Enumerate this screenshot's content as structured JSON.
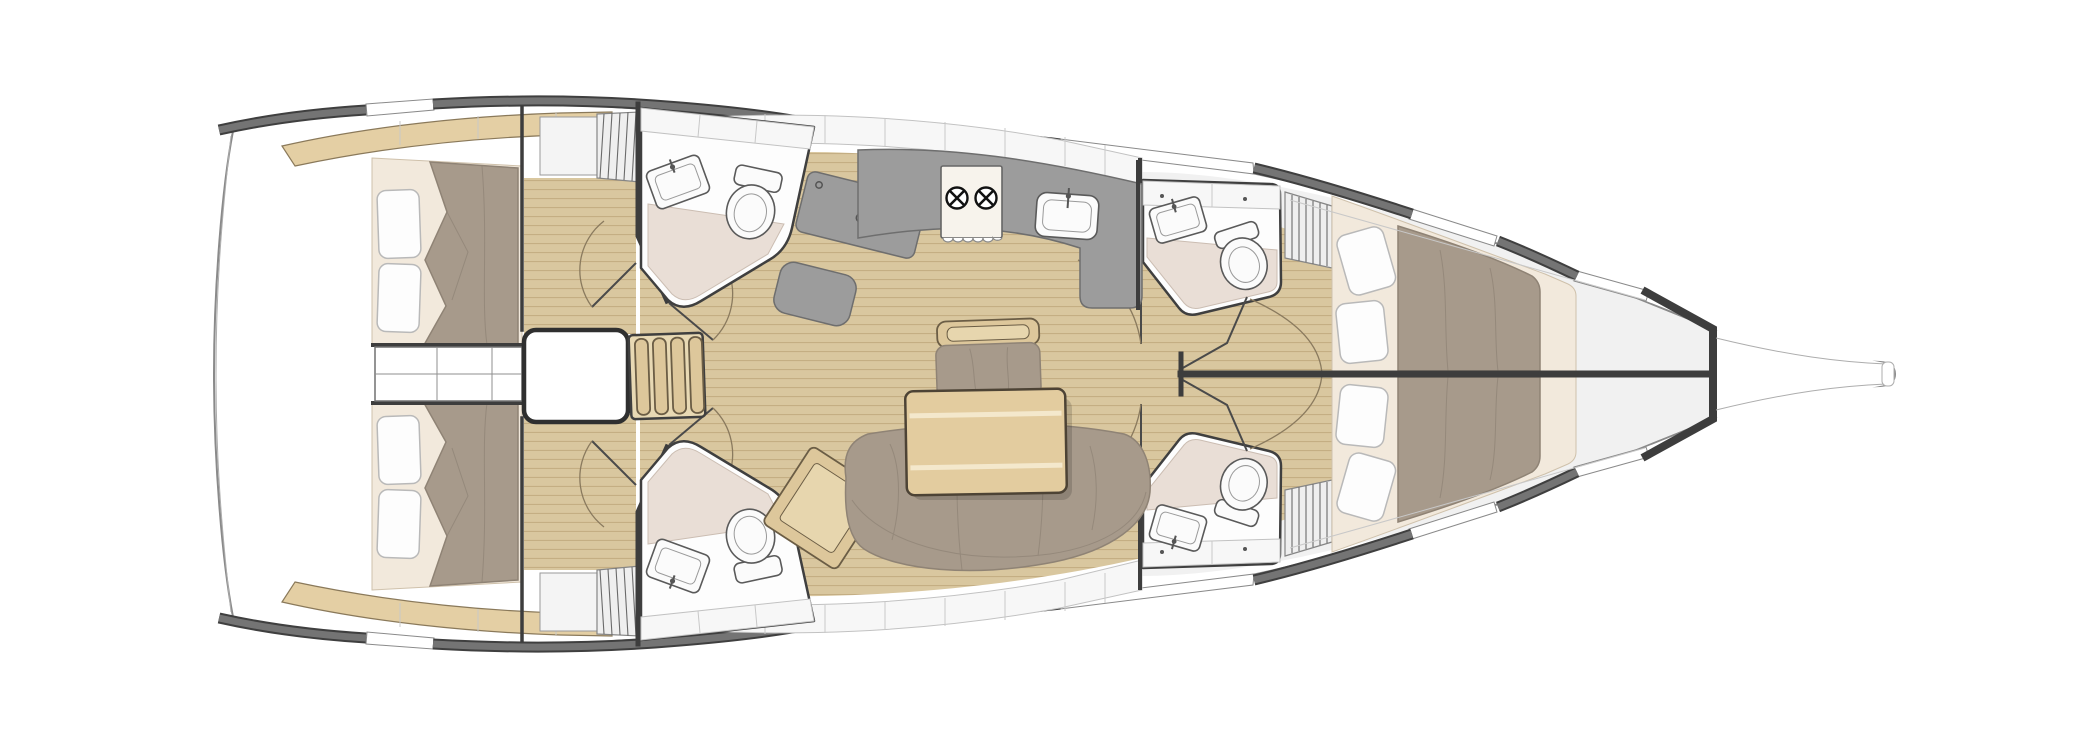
{
  "diagram": {
    "type": "yacht-interior-deck-plan",
    "title": "Sailing yacht interior layout plan — 4 cabins, 4 heads, top view, bow to the right",
    "orientation": {
      "bow": "right",
      "stern": "left",
      "port": "top",
      "starboard": "bottom"
    },
    "palette": {
      "hull_outline": "#8a8a8a",
      "bulkhead": "#3d3d3d",
      "rail": "#747474",
      "rail_edge": "#3f3f3f",
      "floor_wood": "#d9c79f",
      "floor_wood_line": "#ab8f62",
      "furniture_wood": "#ddc79b",
      "furniture_wood_dark": "#6b5d45",
      "upholstery": "#a79a8b",
      "upholstery_dark": "#8f8375",
      "mattress": "#f2e9dc",
      "pillow": "#fdfdfd",
      "counter": "#9c9c9c",
      "shower_floor": "#e9ded6",
      "deck": "#f1f1f1",
      "locker_white": "#f7f7f7"
    },
    "rooms": [
      {
        "id": "aft-cabin-port",
        "label": "Aft cabin port side — double berth with duvet, 2 pillows, wardrobe with louvred door, shelf",
        "pillows": 2
      },
      {
        "id": "aft-cabin-starboard",
        "label": "Aft cabin starboard side — double berth with duvet, 2 pillows, wardrobe with louvred door, shelf",
        "pillows": 2
      },
      {
        "id": "aft-head-port",
        "label": "Aft head port side — washbasin, toilet, shower floor",
        "fixtures": [
          "sink",
          "toilet",
          "shower"
        ]
      },
      {
        "id": "mid-head-starboard",
        "label": "Midship head starboard side — washbasin, toilet, shower floor",
        "fixtures": [
          "sink",
          "toilet",
          "shower"
        ]
      },
      {
        "id": "galley",
        "label": "Galley — L-shaped counter with 2-burner stove and sink",
        "stove_burners": 2,
        "fixtures": [
          "stove",
          "sink"
        ]
      },
      {
        "id": "nav-station",
        "label": "Chart table with seat",
        "fixtures": [
          "chart-table",
          "seat"
        ]
      },
      {
        "id": "salon",
        "label": "Salon — dining table, U-shaped settee, stool bench, chaise seat",
        "fixtures": [
          "table",
          "settee",
          "stool",
          "chaise"
        ]
      },
      {
        "id": "companionway",
        "label": "Companionway — 4-step ladder and engine box between aft cabins",
        "ladder_steps": 4
      },
      {
        "id": "forward-head-port",
        "label": "Forward head port side — washbasin, toilet, shower floor",
        "fixtures": [
          "sink",
          "toilet",
          "shower"
        ]
      },
      {
        "id": "forward-head-starboard",
        "label": "Forward head starboard side — washbasin, toilet, shower floor, vanity drawers",
        "fixtures": [
          "sink",
          "toilet",
          "shower"
        ]
      },
      {
        "id": "forward-cabin-port",
        "label": "Forward cabin port side — berth with duvet and 2 side cushions, louvred locker",
        "pillows": 2
      },
      {
        "id": "forward-cabin-starboard",
        "label": "Forward cabin starboard side — berth with duvet and 2 side cushions, louvred locker",
        "pillows": 2
      },
      {
        "id": "bow-locker",
        "label": "Bow — anchor locker bulkhead and bowsprit"
      }
    ]
  }
}
